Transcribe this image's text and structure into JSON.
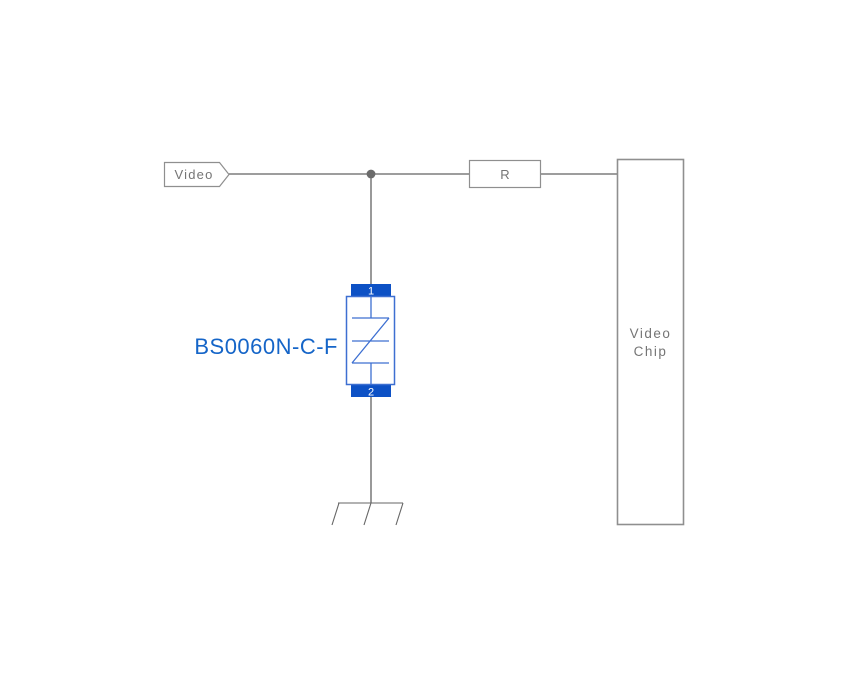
{
  "diagram": {
    "net_label": "Video",
    "resistor_label": "R",
    "chip_label": {
      "line1": "Video",
      "line2": "Chip"
    },
    "component": {
      "label": "BS0060N-C-F",
      "pin1": "1",
      "pin2": "2"
    }
  },
  "colors": {
    "background": "#ffffff",
    "wire": "#8f8f8f",
    "wire_vertical": "#555555",
    "junction": "#6b6b6b",
    "box_border": "#8f8f8f",
    "gray_text": "#757575",
    "component_blue": "#3d6fd1",
    "pad_blue": "#0d51c5",
    "label_blue": "#1565c8",
    "ground": "#666666"
  }
}
